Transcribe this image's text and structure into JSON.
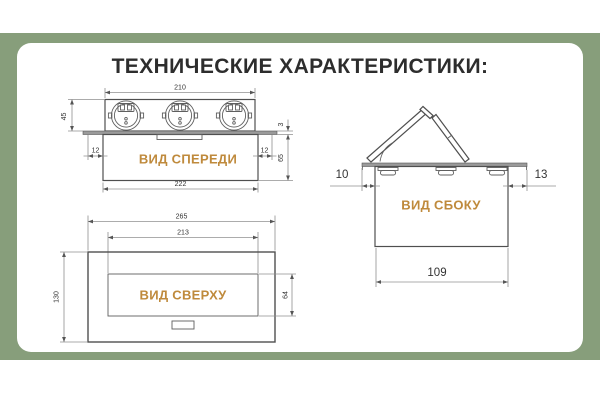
{
  "page": {
    "title": "ТЕХНИЧЕСКИЕ ХАРАКТЕРИСТИКИ:"
  },
  "colors": {
    "band_green": "#879E7B",
    "label_orange": "#BF8A3C",
    "line_dark": "#4F4F4F",
    "dim_gray": "#909090"
  },
  "views": {
    "front": {
      "label": "ВИД СПЕРЕДИ",
      "dims": {
        "top_width": "210",
        "upper_height": "45",
        "offset_left": "12",
        "offset_right": "12",
        "plate_thickness": "3",
        "lower_height": "65",
        "bottom_width": "222"
      }
    },
    "side": {
      "label": "ВИД СБОКУ",
      "dims": {
        "offset_left": "10",
        "offset_right": "13",
        "bottom_width": "109"
      }
    },
    "top": {
      "label": "ВИД СВЕРХУ",
      "dims": {
        "outer_width": "265",
        "inner_width": "213",
        "outer_height": "130",
        "inner_height": "64"
      }
    }
  }
}
